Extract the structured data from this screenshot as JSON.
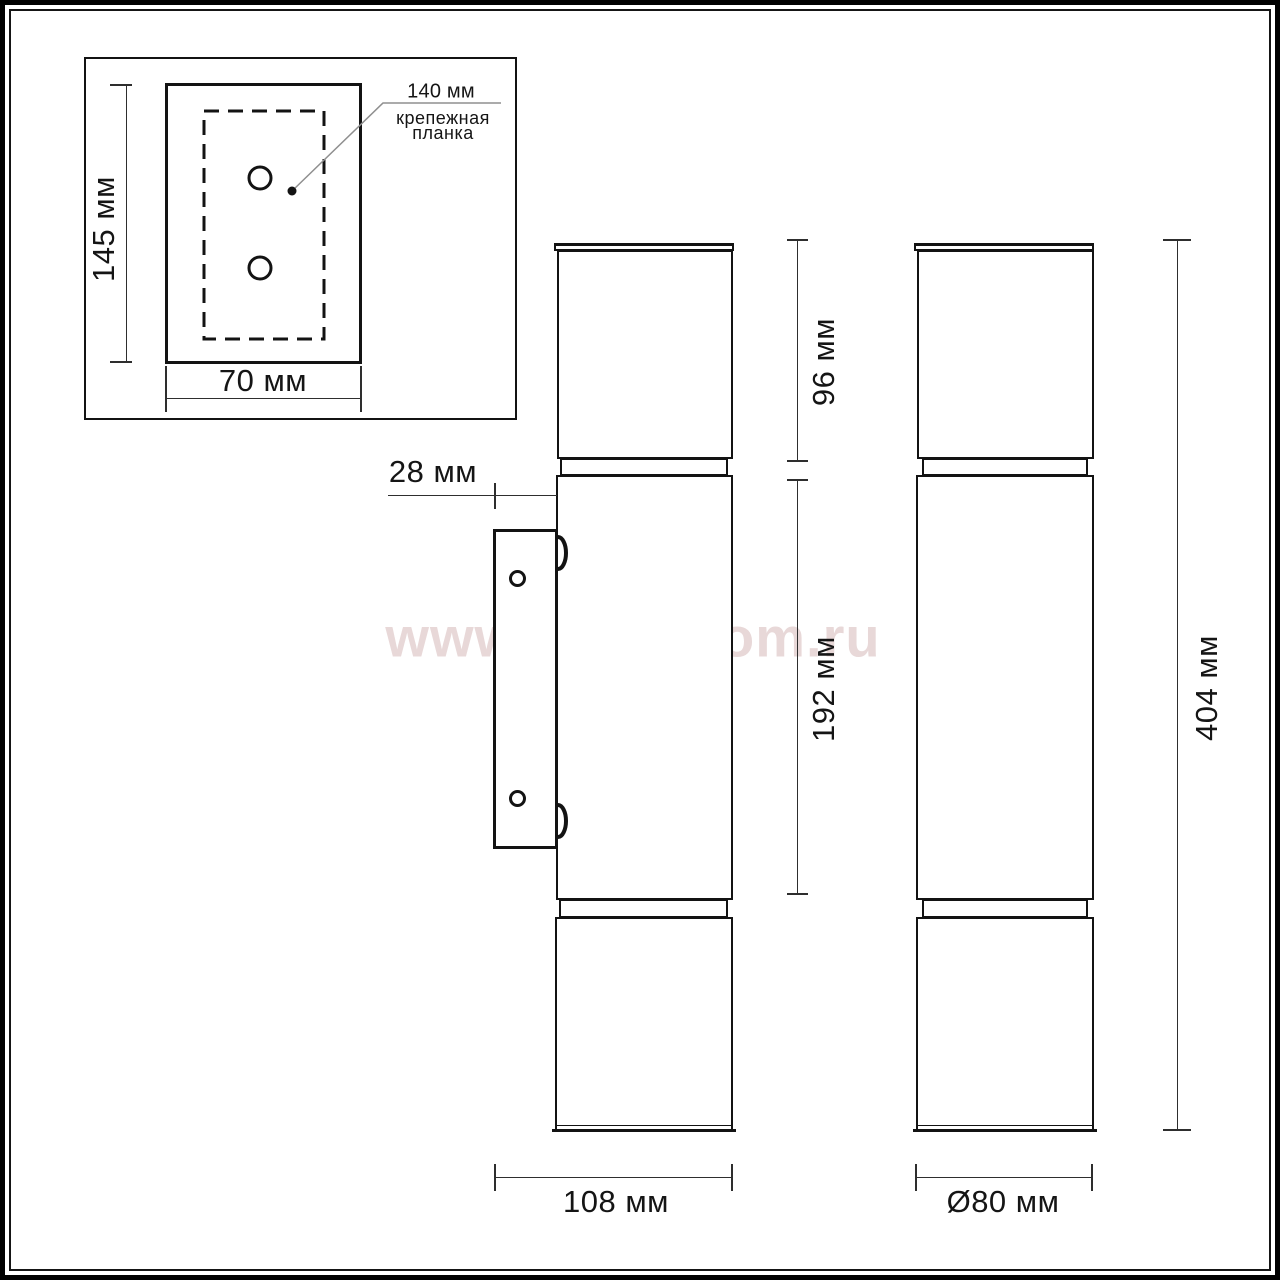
{
  "watermark": {
    "text": "www.svetodom.ru",
    "color": "#e8d8d8"
  },
  "colors": {
    "line": "#131313",
    "dim_line": "#2e2e2e",
    "leader": "#8f8f8f",
    "background": "#ffffff"
  },
  "inset_view": {
    "height_label": "145 мм",
    "width_label": "70 мм",
    "holes_distance_label": "140 мм",
    "callout": {
      "line1": "крепежная",
      "line2": "планка"
    }
  },
  "side_view": {
    "bracket_offset_label": "28 мм",
    "top_section_label": "96 мм",
    "middle_section_label": "192 мм",
    "depth_label": "108 мм"
  },
  "front_view": {
    "total_height_label": "404 мм",
    "diameter_label": "Ø80 мм"
  }
}
